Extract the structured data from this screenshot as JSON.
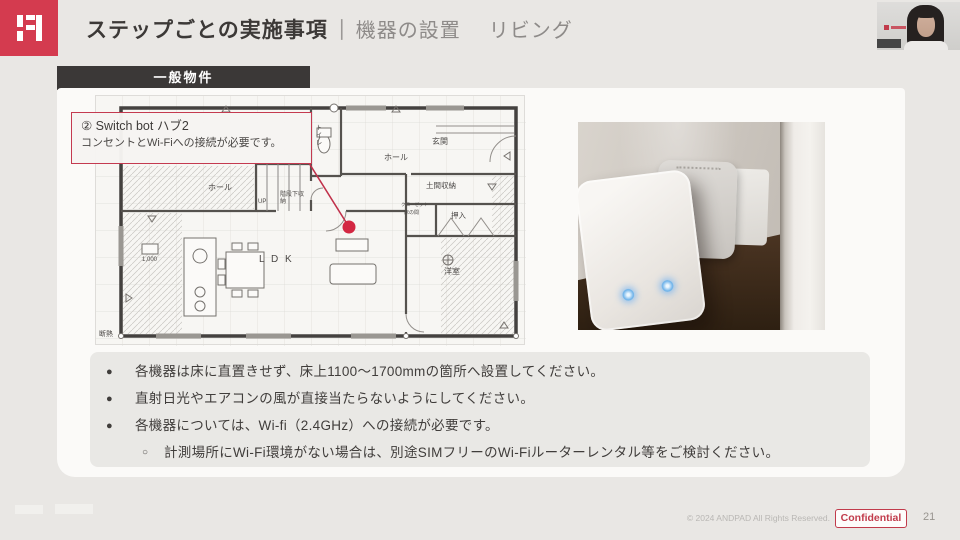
{
  "header": {
    "title_main": "ステップごとの実施事項",
    "title_separator": "｜",
    "title_section": "機器の設置",
    "title_sub": "リビング"
  },
  "badge": {
    "label": "一般物件"
  },
  "callout": {
    "line1": "② Switch bot ハブ2",
    "line2": "コンセントとWi-Fiへの接続が必要です。"
  },
  "floorplan": {
    "labels": [
      {
        "text": "トイレ"
      },
      {
        "text": "玄関"
      },
      {
        "text": "ホール"
      },
      {
        "text": "ホール"
      },
      {
        "text": "UP"
      },
      {
        "text": "階段下収納"
      },
      {
        "text": "土間収納"
      },
      {
        "text": "クローゼット"
      },
      {
        "text": "床の間"
      },
      {
        "text": "押入"
      },
      {
        "text": "洋室"
      },
      {
        "text": "L D K"
      },
      {
        "text": "1,000"
      },
      {
        "text": "断熱"
      }
    ]
  },
  "bullets": {
    "items": [
      {
        "marker": "●",
        "text": "各機器は床に直置きせず、床上1100〜1700mmの箇所へ設置してください。"
      },
      {
        "marker": "●",
        "text": "直射日光やエアコンの風が直接当たらないようにしてください。"
      },
      {
        "marker": "●",
        "text": "各機器については、Wi-fi（2.4GHz）への接続が必要です。"
      },
      {
        "marker": "○",
        "text": "計測場所にWi-Fi環境がない場合は、別途SIMフリーのWi-Fiルーターレンタル等をご検討ください。"
      }
    ]
  },
  "footer": {
    "copyright": "© 2024 ANDPAD All Rights Reserved.",
    "confidential_label": "Confidential",
    "page_number": "21"
  },
  "colors": {
    "brand_red": "#d43b4f",
    "callout_red": "#c43a50",
    "badge_dark": "#3b3837",
    "led_blue": "#6fb3ea"
  }
}
